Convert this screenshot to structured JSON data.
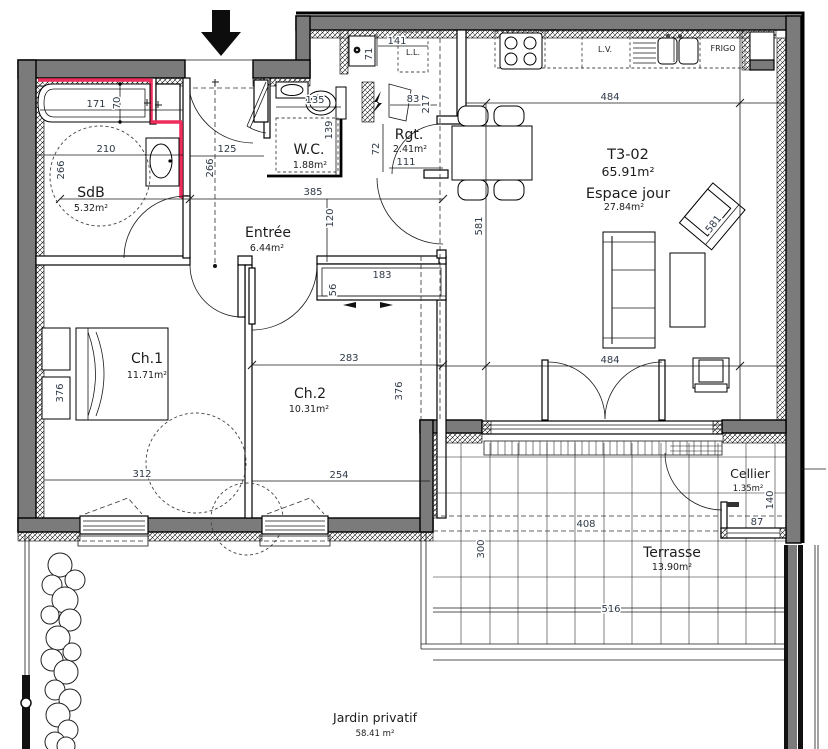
{
  "unit": {
    "name": "T3-02",
    "area": "65.91m²"
  },
  "rooms": {
    "sdb": {
      "name": "SdB",
      "area": "5.32m²"
    },
    "entree": {
      "name": "Entrée",
      "area": "6.44m²"
    },
    "wc": {
      "name": "W.C.",
      "area": "1.88m²"
    },
    "rgt": {
      "name": "Rgt.",
      "area": "2.41m²"
    },
    "espace_jour": {
      "name": "Espace jour",
      "area": "27.84m²"
    },
    "ch1": {
      "name": "Ch.1",
      "area": "11.71m²"
    },
    "ch2": {
      "name": "Ch.2",
      "area": "10.31m²"
    },
    "cellier": {
      "name": "Cellier",
      "area": "1.35m²"
    },
    "terrasse": {
      "name": "Terrasse",
      "area": "13.90m²"
    },
    "jardin": {
      "name": "Jardin privatif",
      "area": "58.41 m²"
    }
  },
  "appliances": {
    "lave_linge": "L.L.",
    "lave_vaisselle": "L.V.",
    "frigo": "FRIGO"
  },
  "dims": {
    "bath_length": "171",
    "bath_width": "70",
    "sdb_width": "210",
    "sdb_depth": "266",
    "entry_width": "125",
    "entry_depth": "266",
    "wc_width": "135",
    "wc_depth": "139",
    "wc_door": "72",
    "rgt_width": "111",
    "hall_width": "385",
    "hall_height": "120",
    "ll_width": "141",
    "ll_height": "71",
    "nook_width": "83",
    "nook_height": "217",
    "kitchen_width": "484",
    "living_height": "581",
    "living_height2": "581",
    "living_width": "484",
    "closet_width": "183",
    "closet_depth": "56",
    "ch2_width": "283",
    "ch2_height": "376",
    "ch1_height": "376",
    "ch1_width": "312",
    "ch2_bottom": "254",
    "terrace_width": "408",
    "cellier_height": "140",
    "cellier_width": "87",
    "terrace_height": "300",
    "terrace_bottom": "516"
  }
}
